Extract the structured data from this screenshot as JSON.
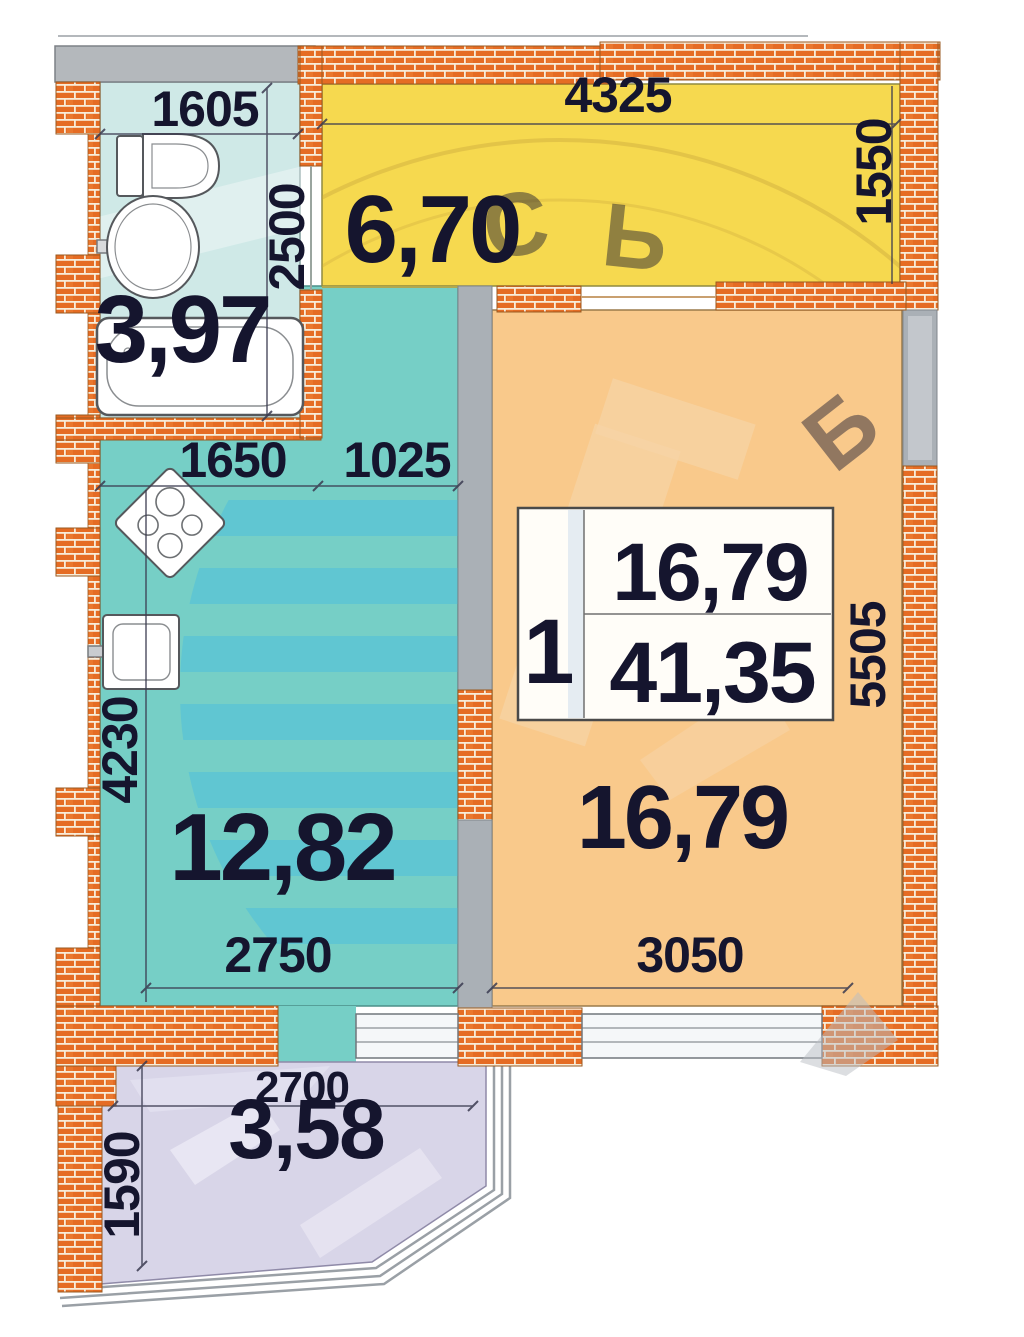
{
  "plan": {
    "info_box": {
      "rooms_count": "1",
      "living_area": "16,79",
      "total_area": "41,35"
    },
    "bathroom": {
      "area": "3,97",
      "dim_width": "1605",
      "dim_height": "2500"
    },
    "hallway": {
      "area": "6,70",
      "dim_width": "4325",
      "dim_height": "1550"
    },
    "kitchen": {
      "area": "12,82",
      "dim_top_left": "1650",
      "dim_top_right": "1025",
      "dim_height": "4230",
      "dim_bottom": "2750"
    },
    "living": {
      "area": "16,79",
      "dim_bottom": "3050",
      "dim_height": "5505"
    },
    "balcony": {
      "area": "3,58",
      "dim_width": "2700",
      "dim_height": "1590"
    },
    "watermark": {
      "letter1": "С",
      "letter2": "Ь",
      "letter3": "Б"
    }
  },
  "colors": {
    "brick": "#e56c24",
    "mortar": "#f8ecd8",
    "wall_gray": "#aab0b6",
    "bathroom": "#cfe9e7",
    "hallway": "#f6d94f",
    "kitchen": "#76cfc6",
    "kitchen_stripe": "#4fc0dc",
    "living": "#f9c98b",
    "balcony": "#d8d5e8",
    "window": "#f5f7f9",
    "text": "#15152e"
  }
}
